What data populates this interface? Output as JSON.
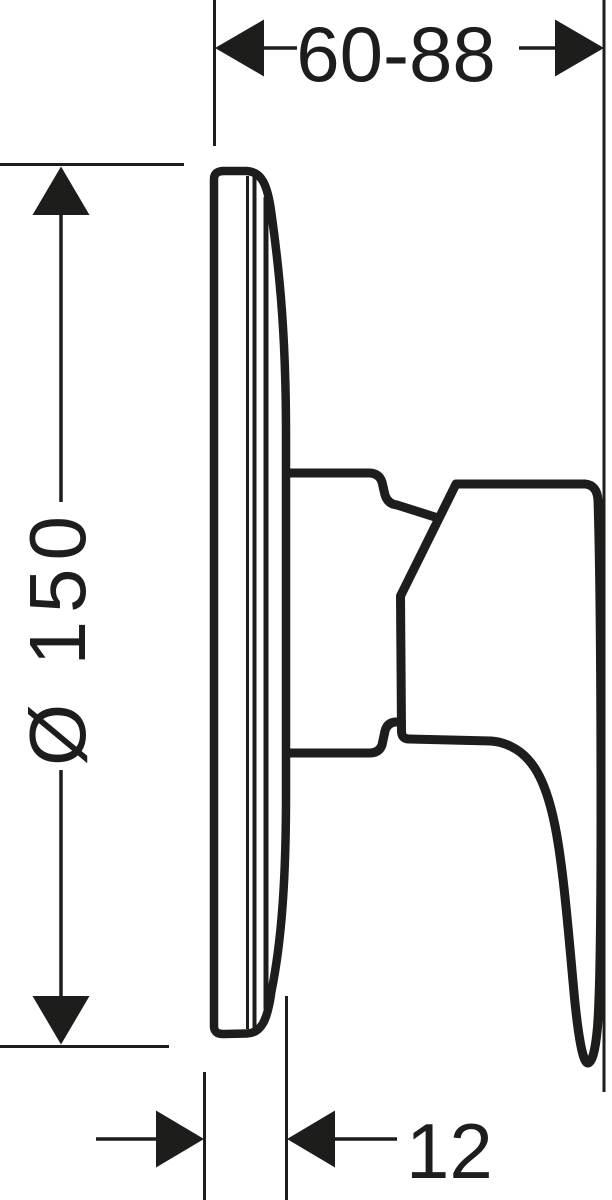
{
  "colors": {
    "line": "#1d1d1b",
    "background": "#ffffff",
    "fill_white": "#ffffff"
  },
  "dimensions": {
    "width_range": {
      "label": "60-88"
    },
    "diameter": {
      "label": "Ø 150"
    },
    "depth": {
      "label": "12"
    }
  }
}
